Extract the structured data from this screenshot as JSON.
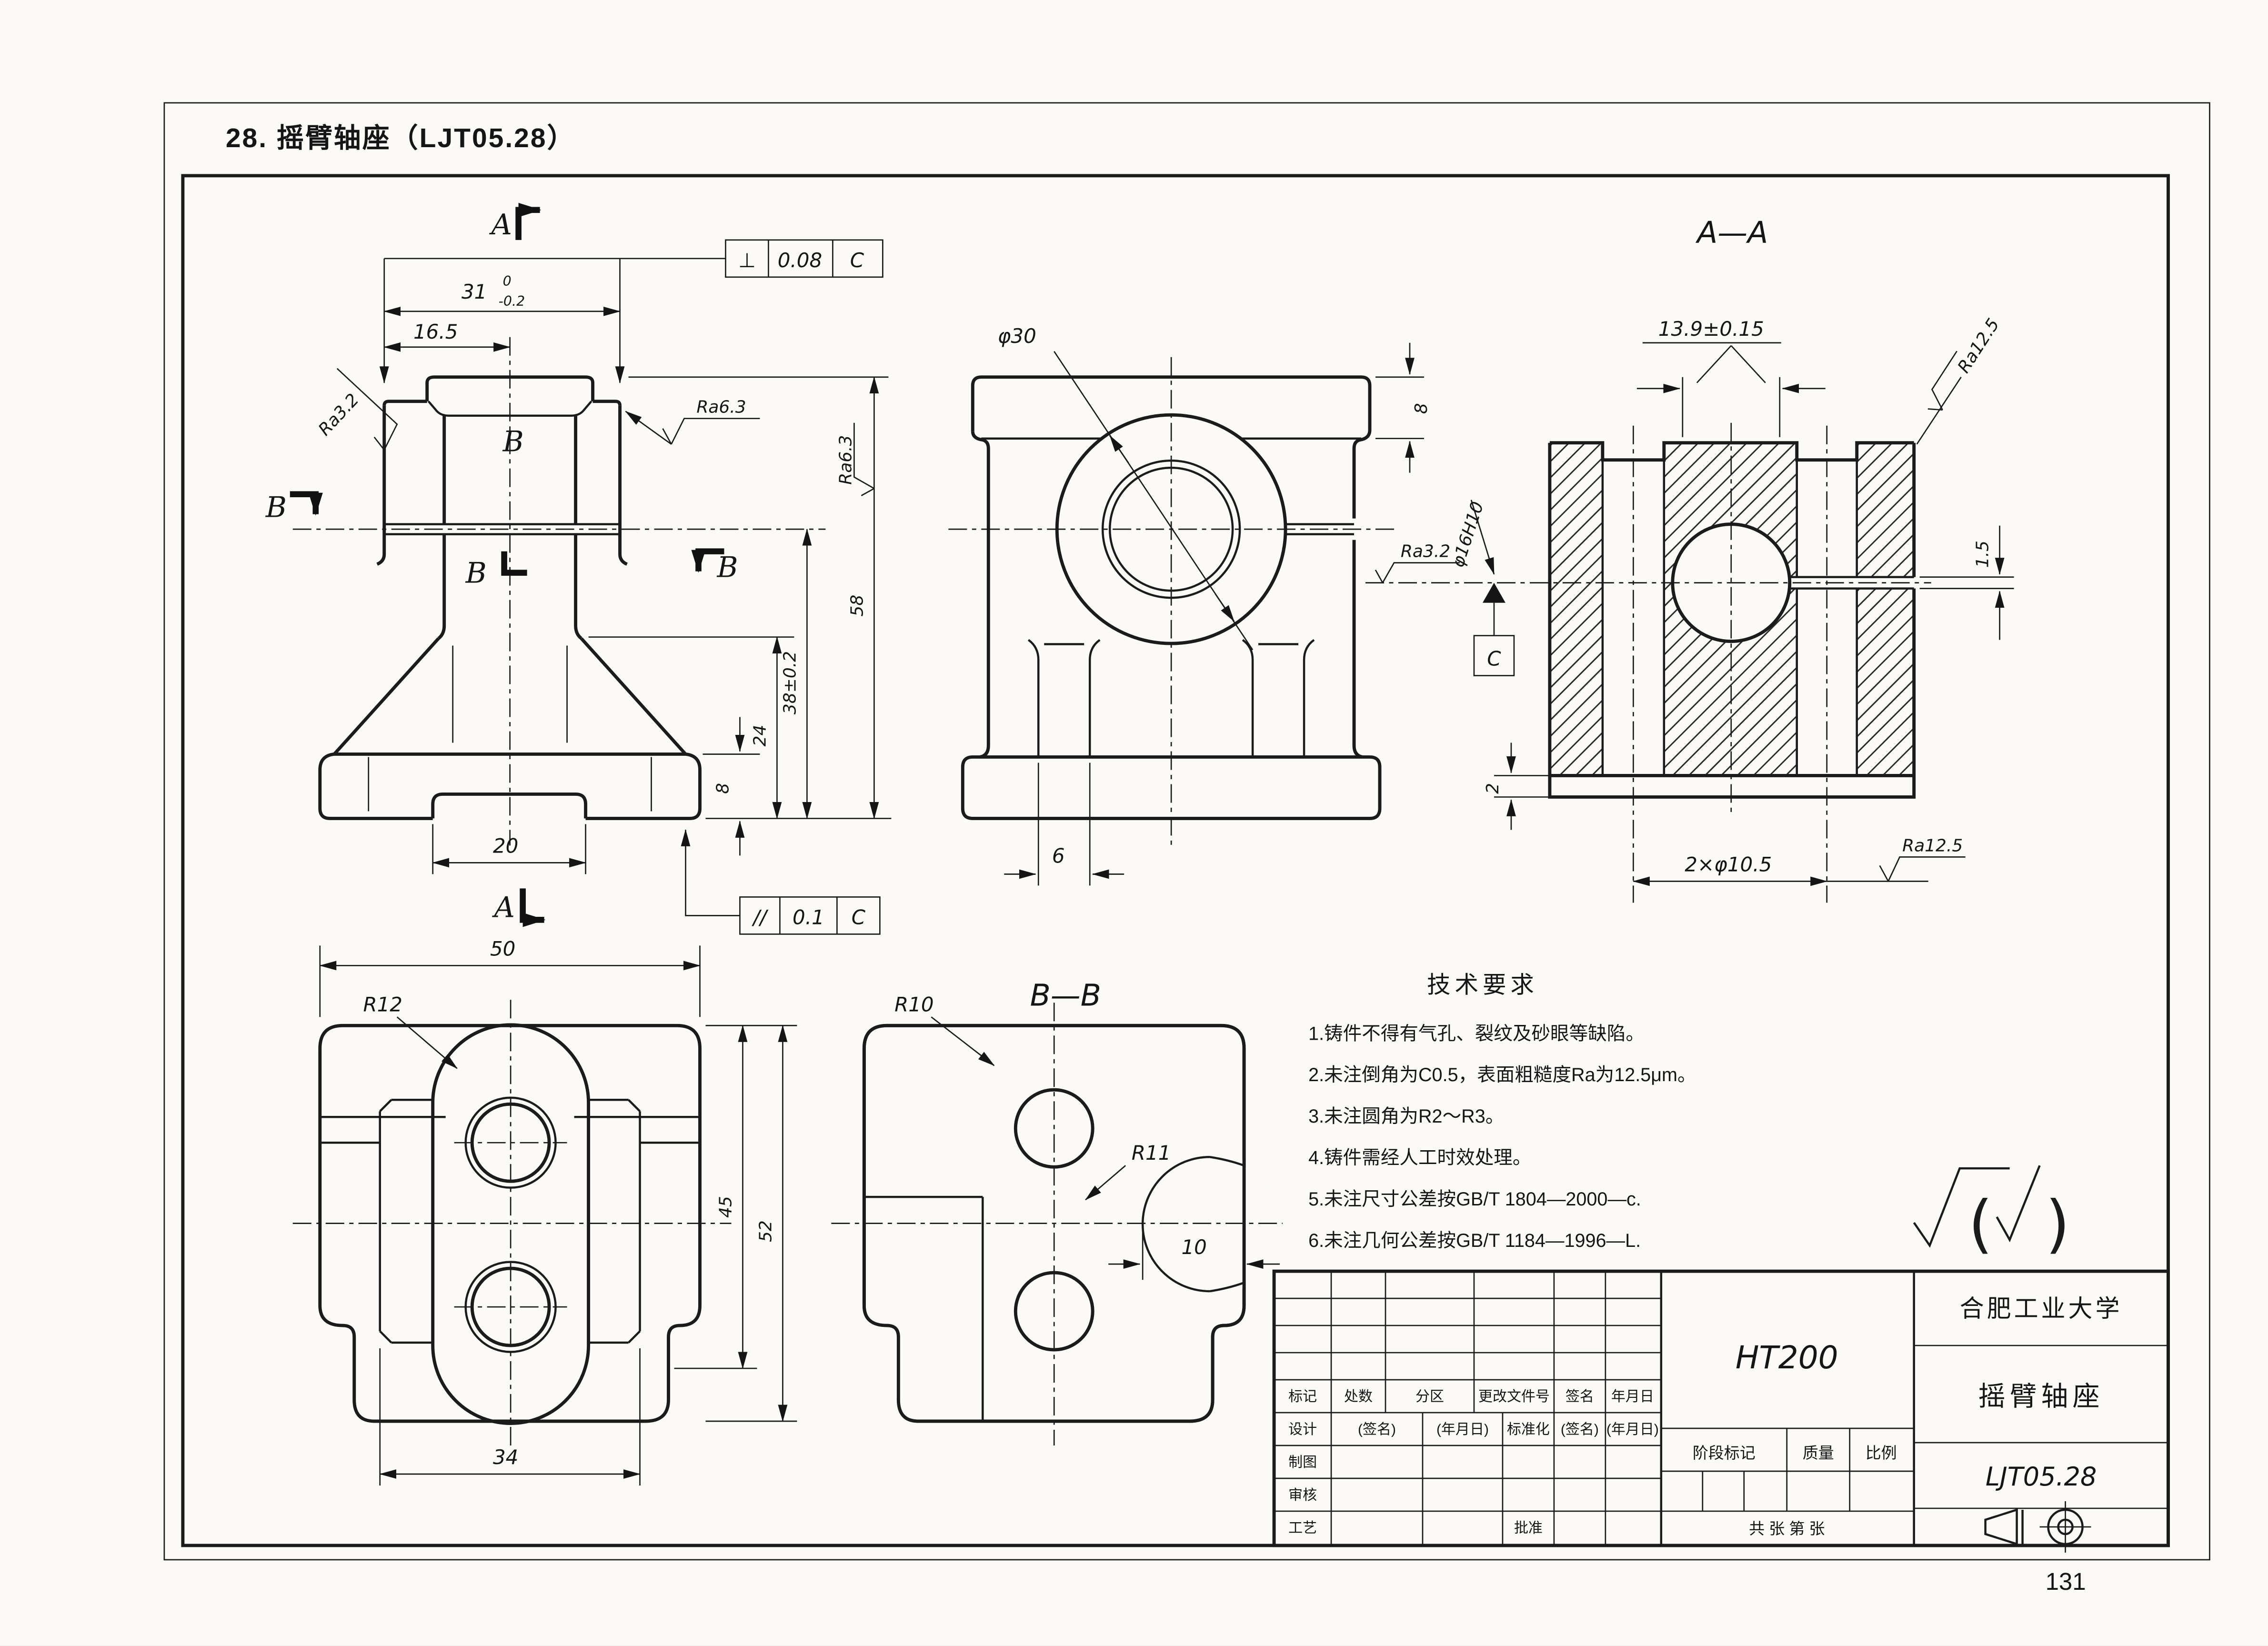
{
  "page": {
    "header_title": "28. 摇臂轴座（LJT05.28）",
    "number": "131"
  },
  "views": {
    "front": {
      "a_top": "A",
      "a_bottom": "A",
      "b_left": "B",
      "b_center": "B",
      "b_lower": "B",
      "b_right": "B",
      "dim_31": "31",
      "dim_31_up": "0",
      "dim_31_dn": "-0.2",
      "dim_165": "16.5",
      "dim_20": "20",
      "dim_8": "8",
      "dim_24": "24",
      "dim_38": "38±0.2",
      "dim_58": "58",
      "ra_left": "Ra3.2",
      "ra_mid": "Ra6.3",
      "ra_right": "Ra6.3",
      "fcf_perp": {
        "sym": "⊥",
        "tol": "0.08",
        "datum": "C"
      },
      "fcf_par": {
        "sym": "//",
        "tol": "0.1",
        "datum": "C"
      }
    },
    "side": {
      "dim_d30": "φ30",
      "dim_8": "8",
      "dim_6": "6"
    },
    "section_aa": {
      "title": "A—A",
      "dim_139": "13.9±0.15",
      "ra_top": "Ra12.5",
      "dim_15": "1.5",
      "dim_d16": "φ16H10",
      "ra_bore": "Ra3.2",
      "datum": "C",
      "dim_2": "2",
      "dim_holes": "2×φ10.5",
      "ra_bottom": "Ra12.5"
    },
    "plan": {
      "dim_50": "50",
      "r12": "R12",
      "dim_45": "45",
      "dim_52": "52",
      "dim_34": "34"
    },
    "section_bb": {
      "title": "B—B",
      "r10": "R10",
      "r11": "R11",
      "dim_10": "10"
    }
  },
  "tech": {
    "title": "技术要求",
    "items": [
      "1.铸件不得有气孔、裂纹及砂眼等缺陷。",
      "2.未注倒角为C0.5，表面粗糙度Ra为12.5μm。",
      "3.未注圆角为R2～R3。",
      "4.铸件需经人工时效处理。",
      "5.未注尺寸公差按GB/T 1804—2000—c.",
      "6.未注几何公差按GB/T 1184—1996—L."
    ],
    "note_open": "(",
    "note_close": ")"
  },
  "titleblock": {
    "rev_headers": [
      "标记",
      "处数",
      "分区",
      "更改文件号",
      "签名",
      "年月日"
    ],
    "design_row": [
      "设计",
      "(签名)",
      "(年月日)",
      "标准化",
      "(签名)",
      "(年月日)"
    ],
    "row_draw": "制图",
    "row_check": "审核",
    "row_process": "工艺",
    "approve": "批准",
    "material": "HT200",
    "stage_label": "阶段标记",
    "quality_label": "质量",
    "scale_label": "比例",
    "sheets": "共  张  第  张",
    "company": "合肥工业大学",
    "part_name": "摇臂轴座",
    "drawing_no": "LJT05.28"
  },
  "colors": {
    "ink": "#1b1b1b",
    "paper": "#fbfaf6"
  }
}
